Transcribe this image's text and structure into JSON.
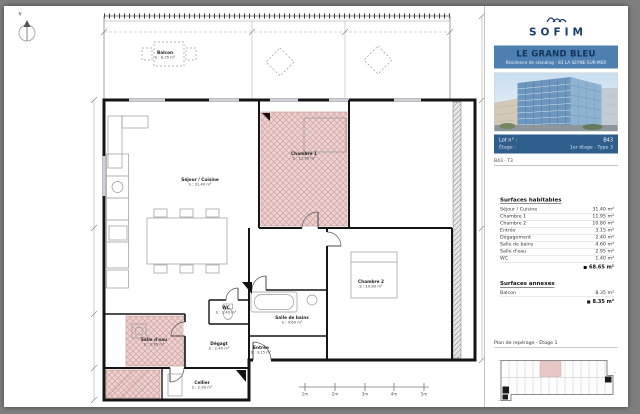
{
  "colors": {
    "banner_blue": "#4d80b0",
    "navy": "#1c3e6b",
    "highlight_pink": "#ecd2d0"
  },
  "plan": {
    "north_label": "N",
    "rooms": [
      {
        "name": "Balcon",
        "area": "S : 8.35 m²"
      },
      {
        "name": "Séjour / Cuisine",
        "area": "S : 31.40 m²"
      },
      {
        "name": "Chambre 1",
        "area": "S : 11.95 m²"
      },
      {
        "name": "Chambre 2",
        "area": "S : 10.80 m²"
      },
      {
        "name": "Salle de bains",
        "area": "S : 4.60 m²"
      },
      {
        "name": "Salle d'eau",
        "area": "S : 2.95 m²"
      },
      {
        "name": "Dégagt",
        "area": "S : 2.40 m²"
      },
      {
        "name": "Entrée",
        "area": "S : 3.15 m²"
      },
      {
        "name": "WC",
        "area": "S : 1.40 m²"
      },
      {
        "name": "Cellier",
        "area": "S : 2.90 m²"
      }
    ],
    "scale_labels": [
      "1m",
      "2m",
      "3m",
      "4m",
      "5m"
    ]
  },
  "panel": {
    "logo_text": "SOFIM",
    "banner": {
      "title": "LE GRAND BLEU",
      "subtitle": "Résidence de standing - 83 LA SEYNE-SUR-MER"
    },
    "lot_box": {
      "l1_label": "Lot n° :",
      "l1_value": "B43",
      "l2_label": "Étage :",
      "l2_value": "1er étage - Type 3"
    },
    "ref_row": "B43 - T3",
    "surfaces": {
      "title": "Surfaces habitables",
      "rows": [
        {
          "label": "Séjour / Cuisine",
          "value": "31.40 m²"
        },
        {
          "label": "Chambre 1",
          "value": "11.95 m²"
        },
        {
          "label": "Chambre 2",
          "value": "10.80 m²"
        },
        {
          "label": "Entrée",
          "value": "3.15 m²"
        },
        {
          "label": "Dégagement",
          "value": "2.40 m²"
        },
        {
          "label": "Salle de bains",
          "value": "4.60 m²"
        },
        {
          "label": "Salle d'eau",
          "value": "2.95 m²"
        },
        {
          "label": "WC",
          "value": "1.40 m²"
        }
      ],
      "total_prefix": "■",
      "total": "68.65 m²"
    },
    "annexes": {
      "title": "Surfaces annexes",
      "rows": [
        {
          "label": "Balcon",
          "value": "8.35 m²"
        }
      ],
      "total_prefix": "■",
      "total": "8.35 m²"
    },
    "keyplan_caption": "Plan de repérage - Étage 1"
  }
}
